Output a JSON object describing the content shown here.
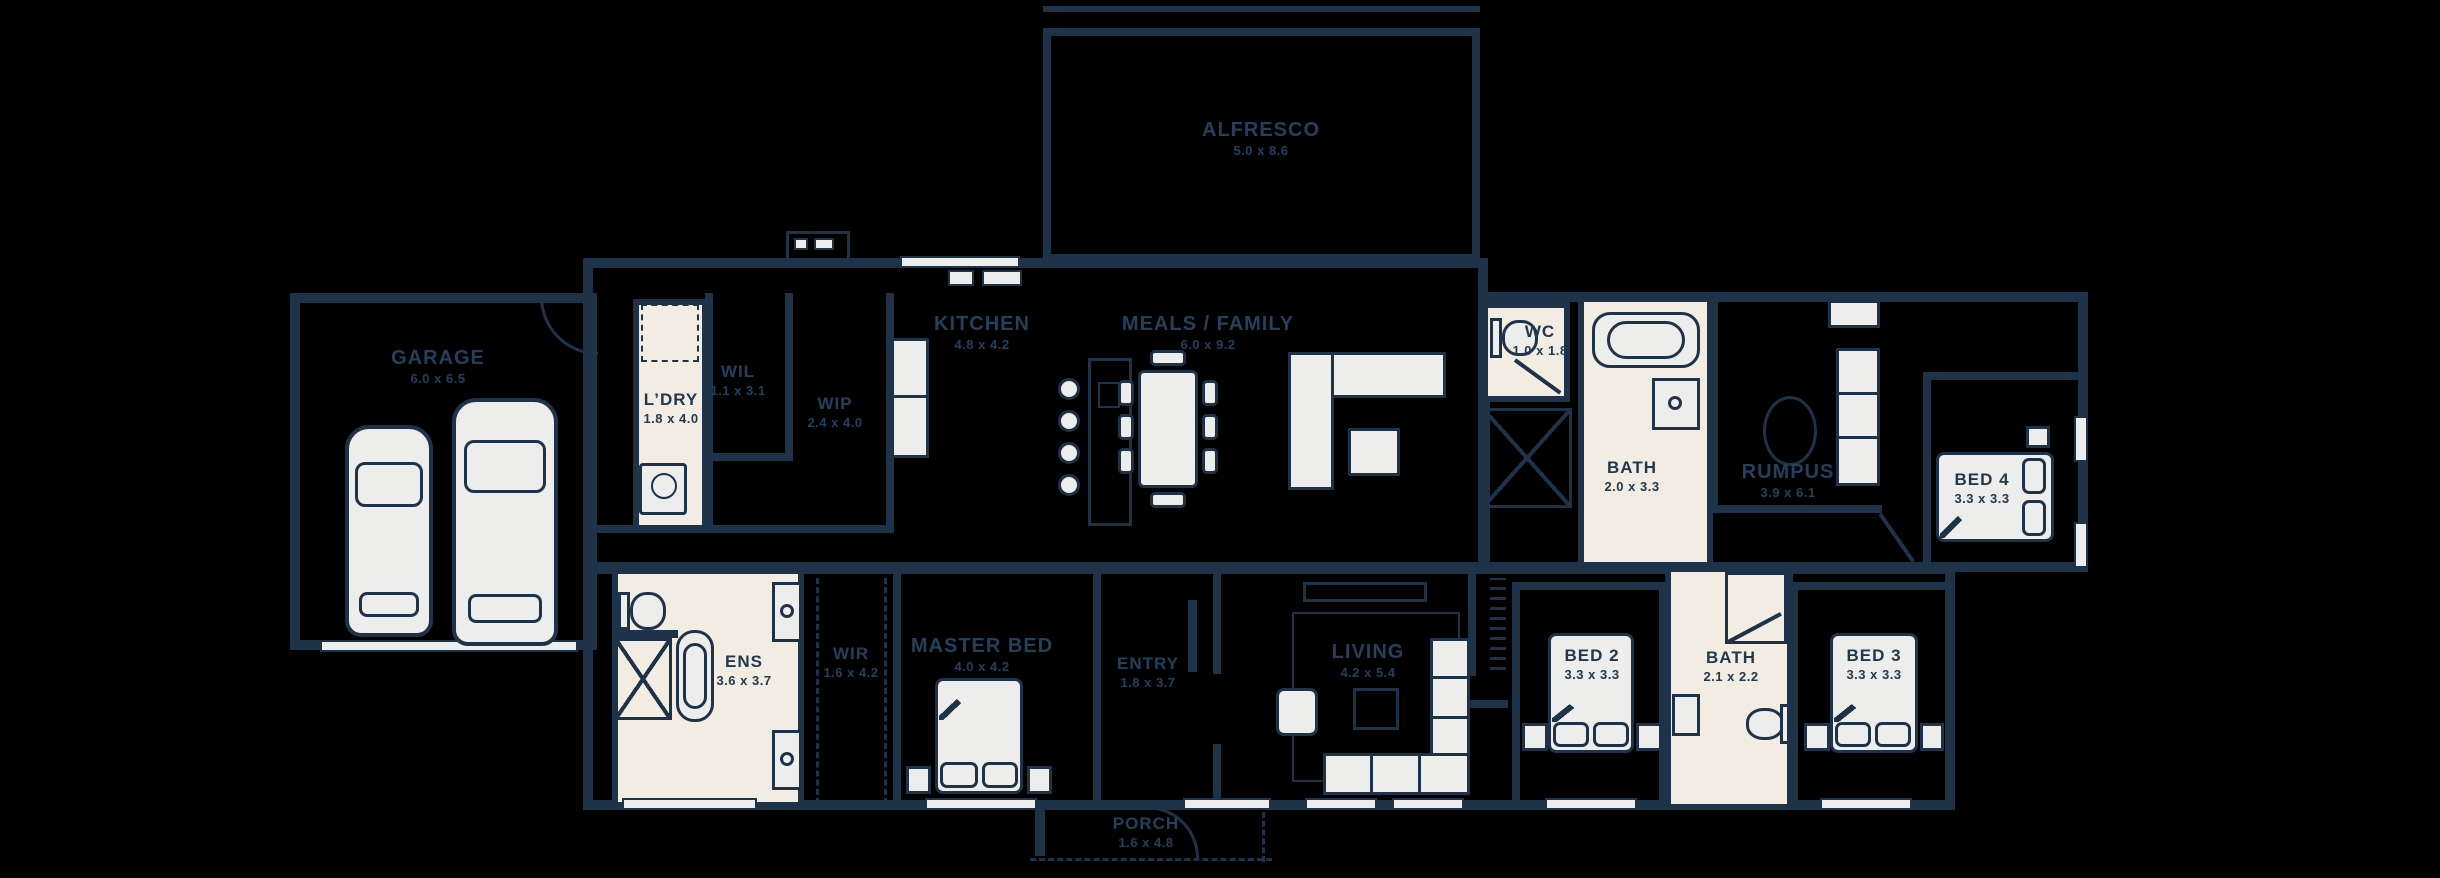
{
  "plan": {
    "type": "single-storey house floor plan",
    "rooms": {
      "garage": {
        "name": "GARAGE",
        "dims": "6.0 x 6.5"
      },
      "alfresco": {
        "name": "ALFRESCO",
        "dims": "5.0 x 8.6"
      },
      "ldry": {
        "name": "L’DRY",
        "dims": "1.8 x 4.0"
      },
      "wil": {
        "name": "WIL",
        "dims": "1.1 x 3.1"
      },
      "wip": {
        "name": "WIP",
        "dims": "2.4 x 4.0"
      },
      "kitchen": {
        "name": "KITCHEN",
        "dims": "4.8 x 4.2"
      },
      "meals_family": {
        "name": "MEALS / FAMILY",
        "dims": "6.0 x 9.2"
      },
      "wc": {
        "name": "WC",
        "dims": "1.0 x 1.8"
      },
      "bath1": {
        "name": "BATH",
        "dims": "2.0 x 3.3"
      },
      "rumpus": {
        "name": "RUMPUS",
        "dims": "3.9 x 6.1"
      },
      "bed4": {
        "name": "BED 4",
        "dims": "3.3 x 3.3"
      },
      "ens": {
        "name": "ENS",
        "dims": "3.6 x 3.7"
      },
      "wir": {
        "name": "WIR",
        "dims": "1.6 x 4.2"
      },
      "master_bed": {
        "name": "MASTER BED",
        "dims": "4.0 x 4.2"
      },
      "entry": {
        "name": "ENTRY",
        "dims": "1.8 x 3.7"
      },
      "living": {
        "name": "LIVING",
        "dims": "4.2 x 5.4"
      },
      "bed2": {
        "name": "BED 2",
        "dims": "3.3 x 3.3"
      },
      "bath2": {
        "name": "BATH",
        "dims": "2.1 x 2.2"
      },
      "bed3": {
        "name": "BED 3",
        "dims": "3.3 x 3.3"
      },
      "porch": {
        "name": "PORCH",
        "dims": "1.6 x 4.8"
      }
    },
    "colors": {
      "background": "#000000",
      "wall": "#1e3349",
      "cream": "#f2ece2",
      "furniture": "#ededeb",
      "label_on_dark": "#24405c",
      "label_on_light": "#20394f"
    }
  }
}
